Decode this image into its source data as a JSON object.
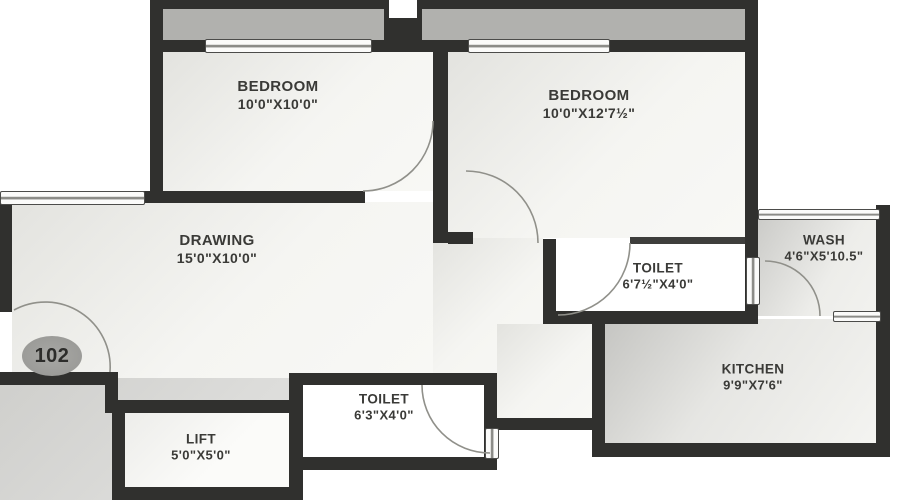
{
  "page": {
    "type": "apartment-floor-plan",
    "unit_number": "102"
  },
  "colors": {
    "wall": "#30302e",
    "balcony": "#b1b1ae",
    "corridor": "#d6d6d3",
    "room_fill": "#f3f3ef",
    "label_text": "#3a3a37",
    "door_arc": "#90908a"
  },
  "rooms": {
    "bedroom1": {
      "name": "BEDROOM",
      "dimensions": "10'0\"X10'0\""
    },
    "bedroom2": {
      "name": "BEDROOM",
      "dimensions": "10'0\"X12'7½\""
    },
    "drawing": {
      "name": "DRAWING",
      "dimensions": "15'0\"X10'0\""
    },
    "toilet1": {
      "name": "TOILET",
      "dimensions": "6'7½\"X4'0\""
    },
    "wash": {
      "name": "WASH",
      "dimensions": "4'6\"X5'10.5\""
    },
    "kitchen": {
      "name": "KITCHEN",
      "dimensions": "9'9\"X7'6\""
    },
    "toilet2": {
      "name": "TOILET",
      "dimensions": "6'3\"X4'0\""
    },
    "lift": {
      "name": "LIFT",
      "dimensions": "5'0\"X5'0\""
    }
  }
}
